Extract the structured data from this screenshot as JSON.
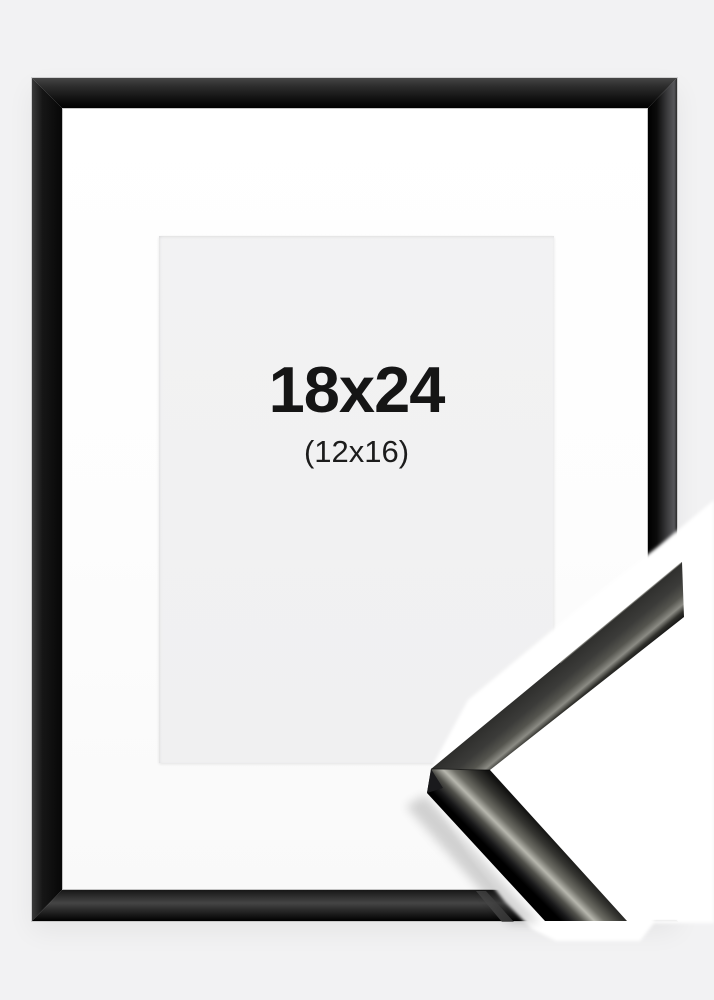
{
  "product_photo": {
    "size_label": "18x24",
    "inner_size_label": "(12x16)",
    "colors": {
      "background": "#f2f2f3",
      "frame_black": "#0d0d0d",
      "frame_sheen": "#57575a",
      "mat_white": "#fdfdfd",
      "opening_gray": "#f0f0f1",
      "label_text": "#151515",
      "moulding_highlight": "#b7b7ae",
      "detail_backdrop": "#ffffff"
    }
  }
}
